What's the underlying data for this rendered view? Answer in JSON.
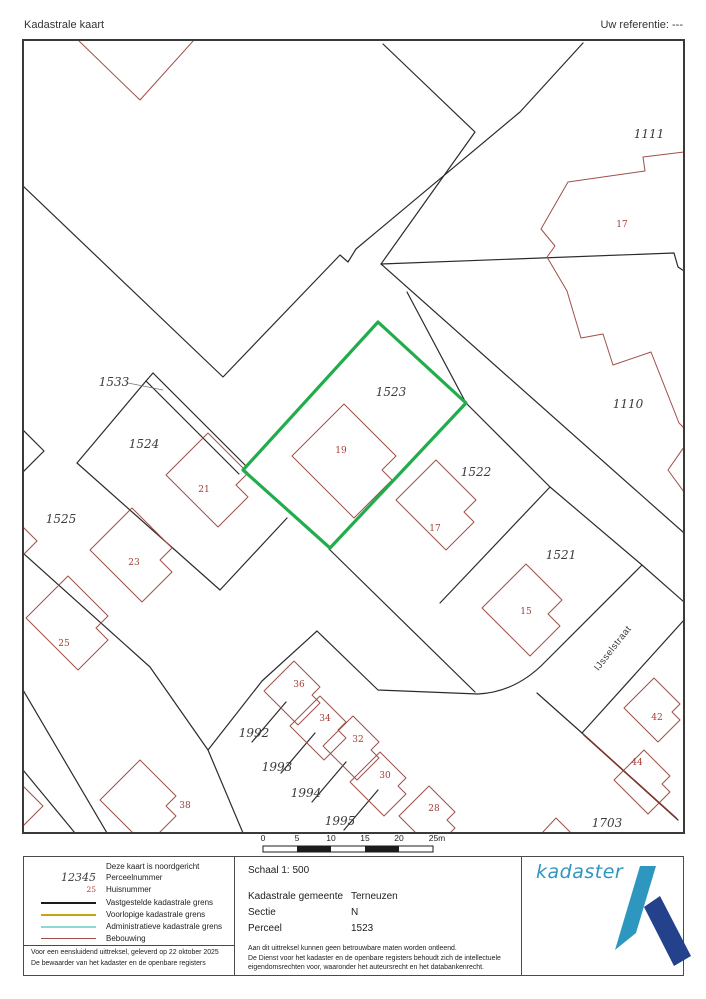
{
  "header": {
    "title": "Kadastrale kaart",
    "reference": "Uw referentie: ---"
  },
  "map": {
    "highlighted_parcel": "1523",
    "street_name": "IJsselstraat",
    "parcel_labels": [
      {
        "text": "1533",
        "x": 114,
        "y": 386
      },
      {
        "text": "1524",
        "x": 144,
        "y": 448
      },
      {
        "text": "1525",
        "x": 61,
        "y": 523
      },
      {
        "text": "1523",
        "x": 391,
        "y": 396
      },
      {
        "text": "1522",
        "x": 476,
        "y": 476
      },
      {
        "text": "1521",
        "x": 561,
        "y": 559
      },
      {
        "text": "1110",
        "x": 628,
        "y": 408
      },
      {
        "text": "1111",
        "x": 649,
        "y": 138
      },
      {
        "text": "1992",
        "x": 254,
        "y": 737
      },
      {
        "text": "1993",
        "x": 277,
        "y": 771
      },
      {
        "text": "1994",
        "x": 306,
        "y": 797
      },
      {
        "text": "1995",
        "x": 340,
        "y": 825
      },
      {
        "text": "1703",
        "x": 607,
        "y": 827
      }
    ],
    "house_numbers": [
      {
        "text": "19",
        "x": 341,
        "y": 453
      },
      {
        "text": "21",
        "x": 204,
        "y": 492
      },
      {
        "text": "23",
        "x": 134,
        "y": 565
      },
      {
        "text": "25",
        "x": 64,
        "y": 646
      },
      {
        "text": "17",
        "x": 435,
        "y": 531
      },
      {
        "text": "15",
        "x": 526,
        "y": 614
      },
      {
        "text": "17",
        "x": 622,
        "y": 227
      },
      {
        "text": "36",
        "x": 299,
        "y": 687
      },
      {
        "text": "34",
        "x": 325,
        "y": 721
      },
      {
        "text": "32",
        "x": 358,
        "y": 742
      },
      {
        "text": "30",
        "x": 385,
        "y": 778
      },
      {
        "text": "28",
        "x": 434,
        "y": 811
      },
      {
        "text": "38",
        "x": 185,
        "y": 808
      },
      {
        "text": "42",
        "x": 657,
        "y": 720
      },
      {
        "text": "44",
        "x": 637,
        "y": 765
      }
    ],
    "scale_ticks": [
      {
        "text": "0",
        "x": 263
      },
      {
        "text": "5",
        "x": 297
      },
      {
        "text": "10",
        "x": 331
      },
      {
        "text": "15",
        "x": 365
      },
      {
        "text": "20",
        "x": 399
      },
      {
        "text": "25m",
        "x": 437
      }
    ]
  },
  "legend": {
    "north_note": "Deze kaart is noordgericht",
    "parcel_sample": "12345",
    "parcel_label": "Perceelnummer",
    "house_sample": "25",
    "house_label": "Huisnummer",
    "lines": [
      {
        "label": "Vastgestelde kadastrale grens",
        "color": "#1c1c1c"
      },
      {
        "label": "Voorlopige kadastrale grens",
        "color": "#c7a215"
      },
      {
        "label": "Administratieve kadastrale grens",
        "color": "#8fd8d2"
      },
      {
        "label": "Bebouwing",
        "color": "#9e5049"
      }
    ]
  },
  "info": {
    "scale": "Schaal 1: 500",
    "rows": [
      {
        "key": "Kadastrale gemeente",
        "value": "Terneuzen"
      },
      {
        "key": "Sectie",
        "value": "N"
      },
      {
        "key": "Perceel",
        "value": "1523"
      }
    ],
    "disclaimer": [
      "Aan dit uittreksel kunnen geen betrouwbare maten worden ontleend.",
      "De Dienst voor het kadaster en de openbare registers behoudt zich de intellectuele",
      "eigendomsrechten voor, waaronder het auteursrecht en het databankenrecht."
    ]
  },
  "footer": {
    "lines": [
      "Voor een eensluidend uittreksel, geleverd op 22 oktober 2025",
      "De bewaarder van het kadaster en de openbare registers"
    ]
  },
  "logo": {
    "word": "kadaster"
  },
  "colors": {
    "highlight_green": "#22ac4b",
    "building_red": "#9e5049",
    "boundary_black": "#2b2b2b",
    "logo_light_blue": "#2e97c0",
    "logo_dark_blue": "#24418c",
    "house_number_red": "#a53c35"
  }
}
